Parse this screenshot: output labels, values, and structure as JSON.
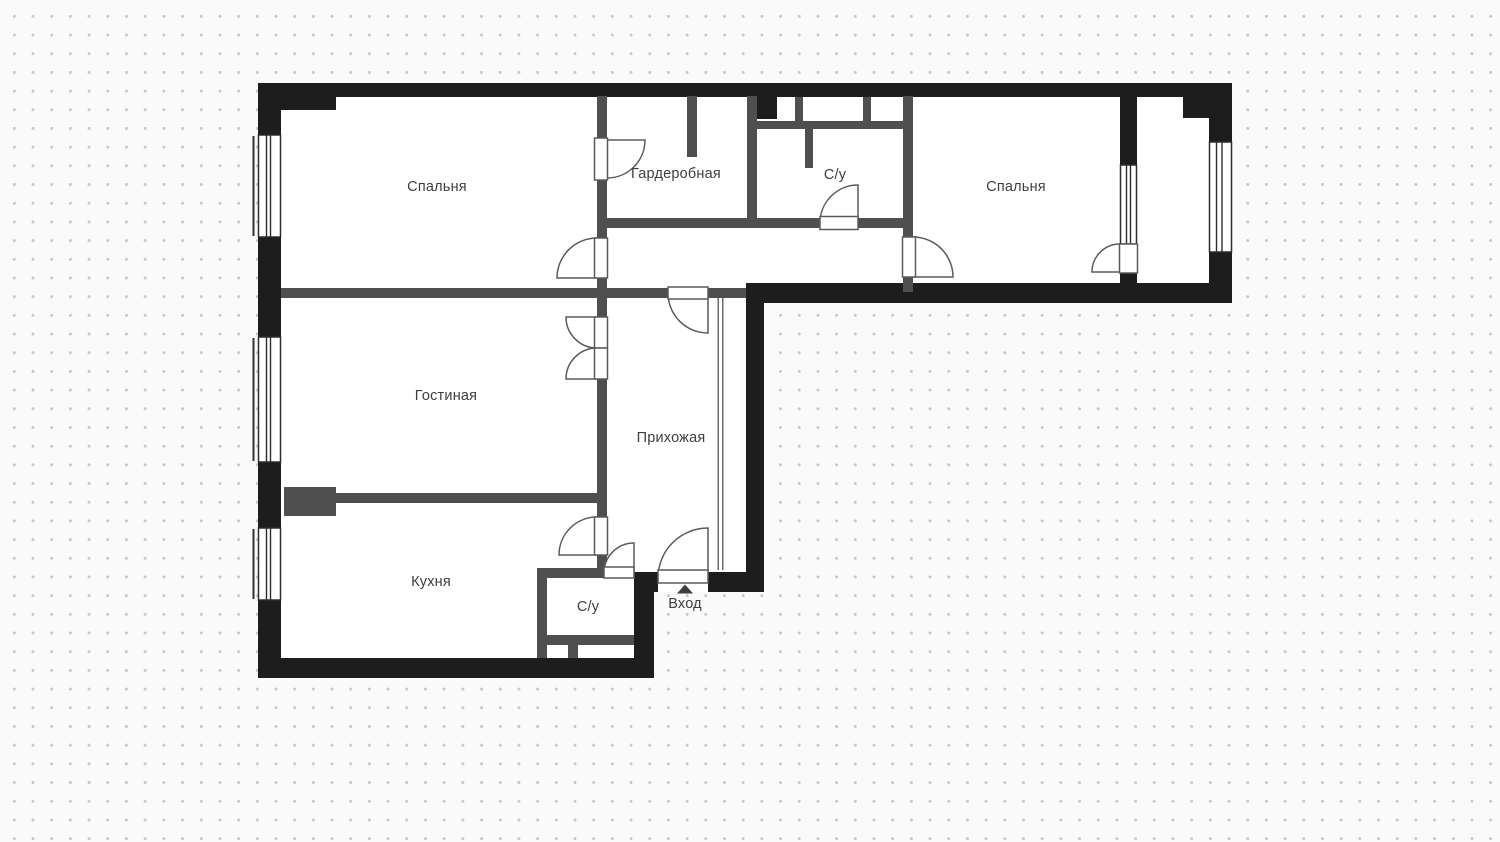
{
  "floorplan": {
    "rooms": [
      {
        "id": "bedroom-1",
        "label": "Спальня"
      },
      {
        "id": "wardrobe",
        "label": "Гардеробная"
      },
      {
        "id": "bathroom-top",
        "label": "С/у"
      },
      {
        "id": "bedroom-2",
        "label": "Спальня"
      },
      {
        "id": "living-room",
        "label": "Гостиная"
      },
      {
        "id": "hallway",
        "label": "Прихожая"
      },
      {
        "id": "kitchen",
        "label": "Кухня"
      },
      {
        "id": "bathroom-bottom",
        "label": "С/у"
      }
    ],
    "entrance": {
      "label": "Вход",
      "marker_icon": "triangle-up-icon"
    },
    "colors": {
      "exterior_wall": "#1d1d1d",
      "interior_wall": "#4f4f4f",
      "floor": "#ffffff",
      "background": "#fafafa",
      "grid_dot": "#c7c7c7",
      "label_text": "#3e3e3e",
      "door_stroke": "#5a5a5a",
      "window_frame": "#2c2c2c"
    }
  }
}
